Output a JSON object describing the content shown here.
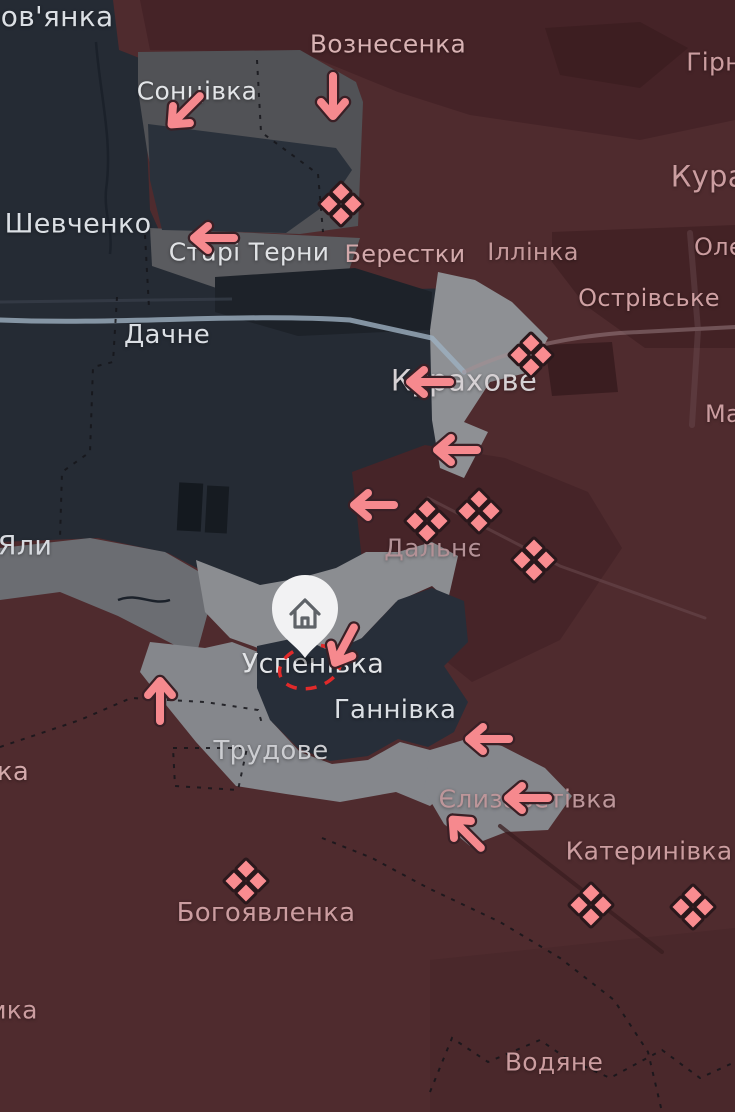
{
  "map": {
    "colors": {
      "occupied_base": "#4f2b2e",
      "occupied_dark": "#452327",
      "controlled_base": "#252b34",
      "controlled_dark": "#1d2229",
      "contested_dark_grey": "#515256",
      "contested_light_grey": "#85878c",
      "road": "#9db0c0",
      "arrow_fill": "#f6898e",
      "arrow_outline": "#3a2026",
      "clash_fill": "#f98c90",
      "clash_outline": "#2a181c",
      "frontline_dash": "#e12a2a",
      "pin_fill": "#f2f2f3",
      "pin_icon": "#5f6368",
      "admin_border": "#15151a"
    },
    "settlement_labels": [
      {
        "text": "лов'янка",
        "x": 48,
        "y": 17,
        "size": 28,
        "color": "#dbdfe4"
      },
      {
        "text": "Вознесенка",
        "x": 388,
        "y": 44,
        "size": 25,
        "color": "#d8b2b3"
      },
      {
        "text": "Гірн",
        "x": 714,
        "y": 62,
        "size": 25,
        "color": "#cb9da0"
      },
      {
        "text": "Сонцівка",
        "x": 197,
        "y": 91,
        "size": 25,
        "color": "#e3e5e8"
      },
      {
        "text": "Курах",
        "x": 717,
        "y": 177,
        "size": 29,
        "color": "#cb9da0"
      },
      {
        "text": "Шевченко",
        "x": 78,
        "y": 224,
        "size": 27,
        "color": "#dbdfe4"
      },
      {
        "text": "Старі Терни",
        "x": 249,
        "y": 252,
        "size": 25,
        "color": "#e0e2e5"
      },
      {
        "text": "Берестки",
        "x": 405,
        "y": 254,
        "size": 24,
        "color": "#d3a9ab"
      },
      {
        "text": "Іллінка",
        "x": 533,
        "y": 252,
        "size": 24,
        "color": "#c5999b"
      },
      {
        "text": "Оле",
        "x": 719,
        "y": 247,
        "size": 24,
        "color": "#cb9da0"
      },
      {
        "text": "Острівське",
        "x": 649,
        "y": 298,
        "size": 24,
        "color": "#cfa1a3"
      },
      {
        "text": "Дачне",
        "x": 167,
        "y": 335,
        "size": 26,
        "color": "#dbdfe4"
      },
      {
        "text": "Курахове",
        "x": 464,
        "y": 381,
        "size": 29,
        "color": "#d6d1d4"
      },
      {
        "text": "Ма",
        "x": 723,
        "y": 414,
        "size": 24,
        "color": "#cb9da0"
      },
      {
        "text": "Яли",
        "x": 25,
        "y": 546,
        "size": 27,
        "color": "#d7dadf"
      },
      {
        "text": "Дальнє",
        "x": 433,
        "y": 548,
        "size": 25,
        "color": "#b39196"
      },
      {
        "text": "Успенівка",
        "x": 313,
        "y": 664,
        "size": 27,
        "color": "#e2e4e7"
      },
      {
        "text": "Ганнівка",
        "x": 395,
        "y": 710,
        "size": 26,
        "color": "#dbdfe4"
      },
      {
        "text": "Трудове",
        "x": 271,
        "y": 751,
        "size": 26,
        "color": "#cccdd1"
      },
      {
        "text": "ка",
        "x": 13,
        "y": 772,
        "size": 26,
        "color": "#d3a9ab"
      },
      {
        "text": "Єлизаветівка",
        "x": 528,
        "y": 799,
        "size": 25,
        "color": "#bd969a"
      },
      {
        "text": "Катеринівка",
        "x": 649,
        "y": 851,
        "size": 25,
        "color": "#cb9da0"
      },
      {
        "text": "Богоявленка",
        "x": 266,
        "y": 913,
        "size": 26,
        "color": "#cb9da0"
      },
      {
        "text": "ика",
        "x": 14,
        "y": 1010,
        "size": 25,
        "color": "#cb9da0"
      },
      {
        "text": "Водяне",
        "x": 554,
        "y": 1062,
        "size": 25,
        "color": "#cb9da0"
      }
    ],
    "clash_markers": [
      {
        "x": 341,
        "y": 204
      },
      {
        "x": 531,
        "y": 355
      },
      {
        "x": 427,
        "y": 521
      },
      {
        "x": 479,
        "y": 511
      },
      {
        "x": 534,
        "y": 560
      },
      {
        "x": 246,
        "y": 881
      },
      {
        "x": 591,
        "y": 905
      },
      {
        "x": 693,
        "y": 907
      }
    ],
    "advance_arrows": [
      {
        "x": 185,
        "y": 111,
        "direction": "southwest",
        "angle": -45
      },
      {
        "x": 333,
        "y": 97,
        "direction": "south",
        "angle": -90
      },
      {
        "x": 213,
        "y": 238,
        "direction": "west",
        "angle": 0
      },
      {
        "x": 429,
        "y": 382,
        "direction": "west",
        "angle": 0
      },
      {
        "x": 456,
        "y": 450,
        "direction": "west",
        "angle": 0
      },
      {
        "x": 373,
        "y": 505,
        "direction": "west",
        "angle": 0
      },
      {
        "x": 344,
        "y": 646,
        "direction": "south-southwest",
        "angle": -62
      },
      {
        "x": 160,
        "y": 700,
        "direction": "north",
        "angle": 90
      },
      {
        "x": 488,
        "y": 739,
        "direction": "west",
        "angle": 0
      },
      {
        "x": 527,
        "y": 798,
        "direction": "west",
        "angle": 0
      },
      {
        "x": 466,
        "y": 833,
        "direction": "northwest",
        "angle": 45
      }
    ],
    "location_pin": {
      "x": 305,
      "y": 613,
      "icon": "home-icon"
    },
    "frontline_circle": {
      "x": 310,
      "y": 667,
      "rx": 31,
      "ry": 21,
      "rotation": -15
    }
  }
}
